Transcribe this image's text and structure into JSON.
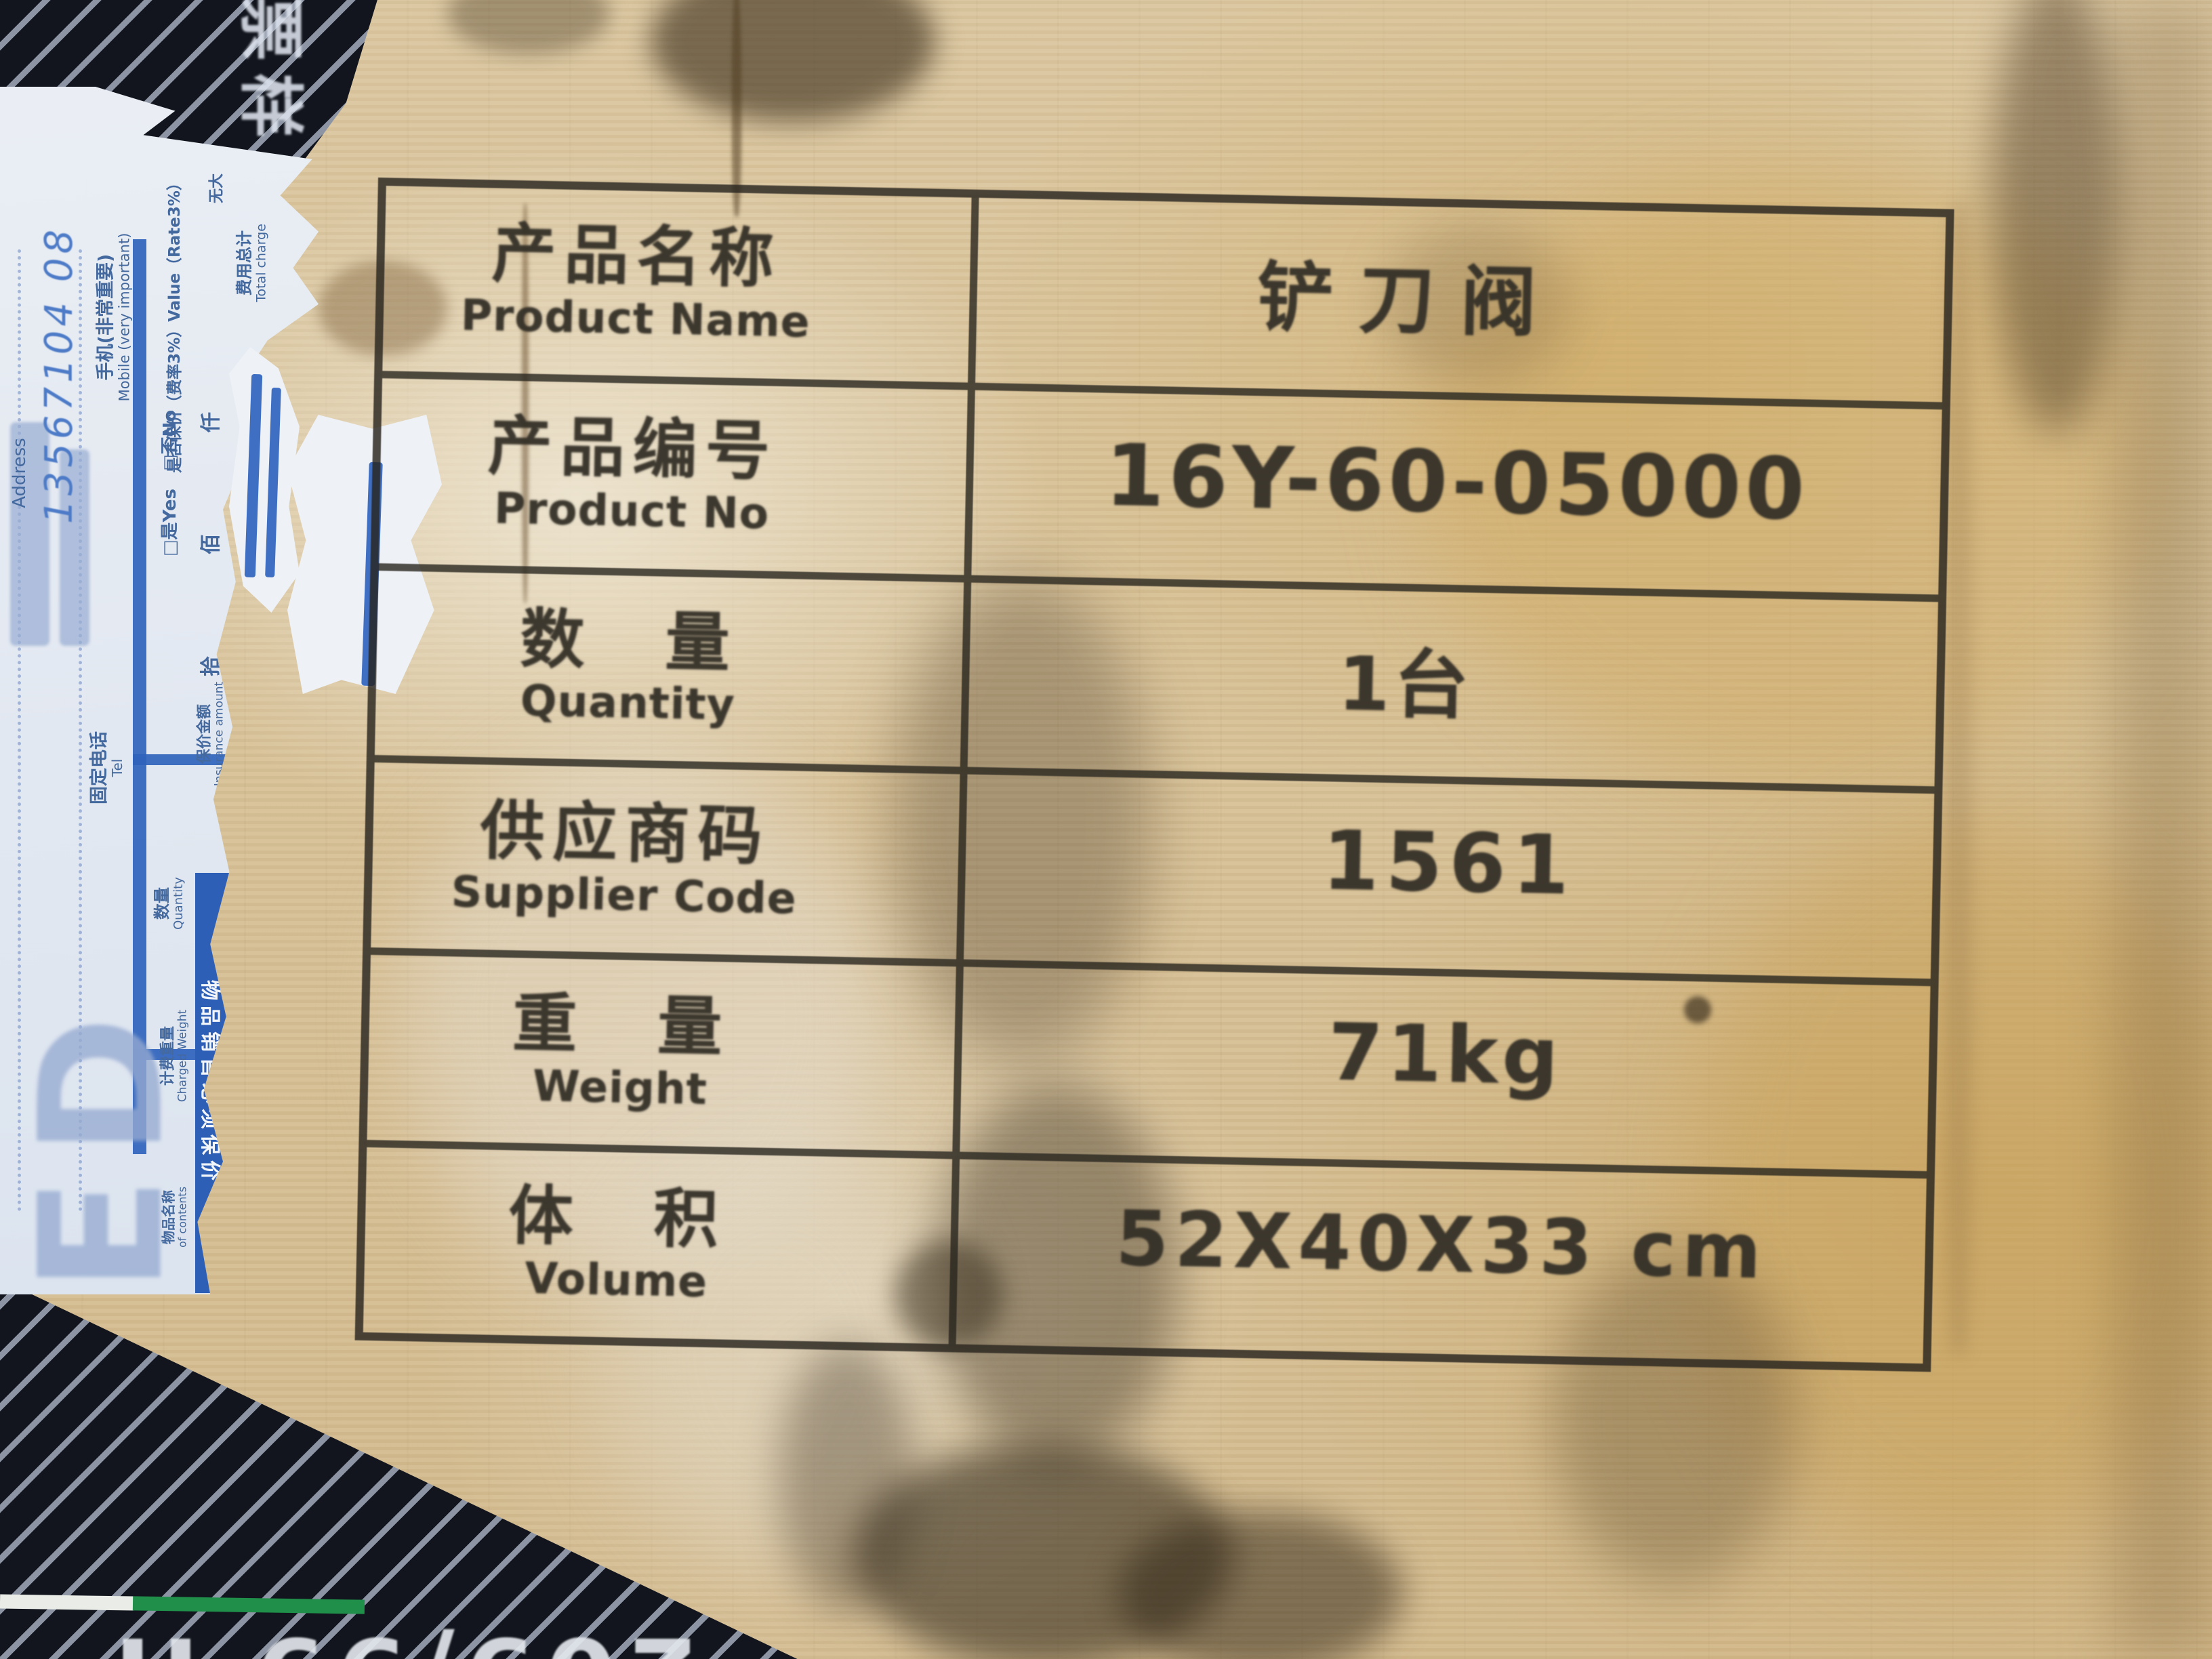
{
  "scene": {
    "description": "Photograph of a plywood shipping crate panel with a black-ink stamped product information table and a torn blue courier waybill label on the left edge"
  },
  "colors": {
    "wood": "#d8c299",
    "ink": "#322e26",
    "label_blue": "#2f63bc",
    "banner_blue": "#2e5fb7",
    "stripe_dark": "#12151d",
    "stripe_light": "#8d95a4",
    "green_line": "#1f8f4a",
    "white_line": "#e9ece7",
    "watermark_blue": "#96aad0",
    "handwriting_blue": "#4d7bc7"
  },
  "table": {
    "rows": [
      {
        "label_cn": "产品名称",
        "label_en": "Product Name",
        "value": "铲刀阀"
      },
      {
        "label_cn": "产品编号",
        "label_en": "Product No",
        "value": "16Y-60-05000"
      },
      {
        "label_cn": "数　量",
        "label_en": "Quantity",
        "value": "1台"
      },
      {
        "label_cn": "供应商码",
        "label_en": "Supplier Code",
        "value": "1561"
      },
      {
        "label_cn": "重　量",
        "label_en": "Weight",
        "value": "71kg"
      },
      {
        "label_cn": "体　积",
        "label_en": "Volume",
        "value": "52X40X33 cm"
      }
    ]
  },
  "waybill": {
    "address_en": "Address",
    "mobile_cn": "手机(非常重要)",
    "mobile_en": "Mobile (very important)",
    "tel_cn": "固定电话",
    "tel_en": "Tel",
    "insured_line": "是否保价（费率3%）Value（Rate3%）",
    "insured_options": "□是Yes　□否No",
    "insurance_amount_cn": "保价金额",
    "insurance_amount_en": "Insurance amount",
    "total_charge_cn": "费用总计",
    "total_charge_en": "Total charge",
    "digit_columns": "拾　佰　仟",
    "no_caps": "无大",
    "kg": "KG",
    "quantity_cn": "数量",
    "quantity_en": "Quantity",
    "charged_weight_cn": "计费重量",
    "charged_weight_en": "Charged Weight",
    "contents_cn": "物品名称",
    "contents_en": "of contents",
    "banner": "物品销售必须保价",
    "handwritten_phone": "13567104 08",
    "handwritten_amount": "53",
    "watermark_letters": "ED"
  },
  "stripe_print": {
    "top_vertical_chars": "票样",
    "bottom_stencil_text": "209/99 H"
  }
}
